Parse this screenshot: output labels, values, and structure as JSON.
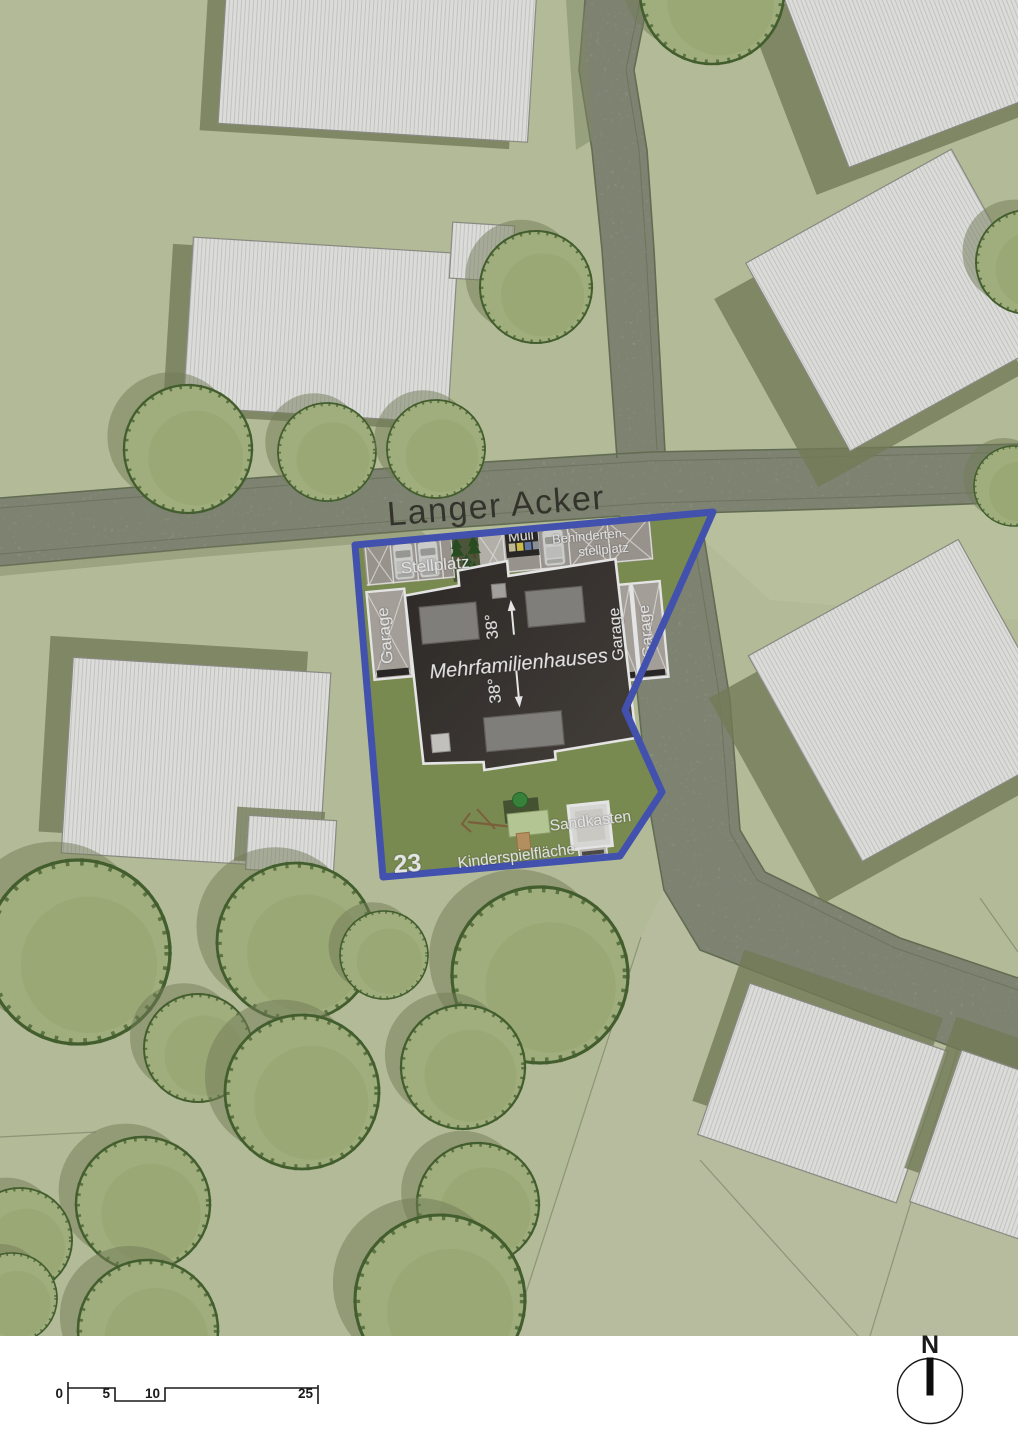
{
  "colors": {
    "page-bg": "#ffffff",
    "grass": "#c8d1a9",
    "grass-light": "#d0d8b4",
    "road": "#b5bca4",
    "road-edge": "#6e795c",
    "verge": "#8d9770",
    "site-lawn": "#879b59",
    "boundary": "#4a5bc2",
    "roof": "#3a3632",
    "bld-outline": "#9a9a92",
    "stripe": "#d9d9d5",
    "shadow": "#7f8a62",
    "tree-fill": "#b3c28b",
    "tree-inner": "#a5b87c",
    "tree-outline": "#4c6a34",
    "asphalt": "#aba49d",
    "concrete": "#c8c4bd",
    "garage-fill": "#b7b1aa",
    "car-body": "#e4e4e1",
    "label-white": "#ffffff",
    "street-text": "#3a3a32",
    "ink": "#1a1a1a",
    "bin-beige": "#d8cfa4",
    "bin-yellow": "#e3cf52",
    "bin-blue": "#6c87ba",
    "bin-gray": "#9aa0a6",
    "play-roof": "#3f9141",
    "play-deck": "#4d5c38",
    "play-panel": "#c9dda4",
    "play-wood": "#c9a06b",
    "conifer": "#2c5527",
    "strip-bg": "#556040"
  },
  "map": {
    "street_label": "Langer Acker",
    "north_label": "N",
    "scale_bar": {
      "ticks": [
        "0",
        "5",
        "10",
        "25"
      ]
    },
    "site": {
      "parcel_number": "23",
      "building_label": "Mehrfamilienhauses",
      "roof_pitch_up": "38°",
      "roof_pitch_down": "38°",
      "parking_label": "Stellplatz",
      "waste_label": "Müll",
      "accessible_line1": "Behinderten-",
      "accessible_line2": "stellplatz",
      "garage_left": "Garage",
      "garage_right_1": "Garage",
      "garage_right_2": "Garage",
      "playground_label": "Kinderspielfläche",
      "sandbox_label": "Sandkasten"
    }
  }
}
